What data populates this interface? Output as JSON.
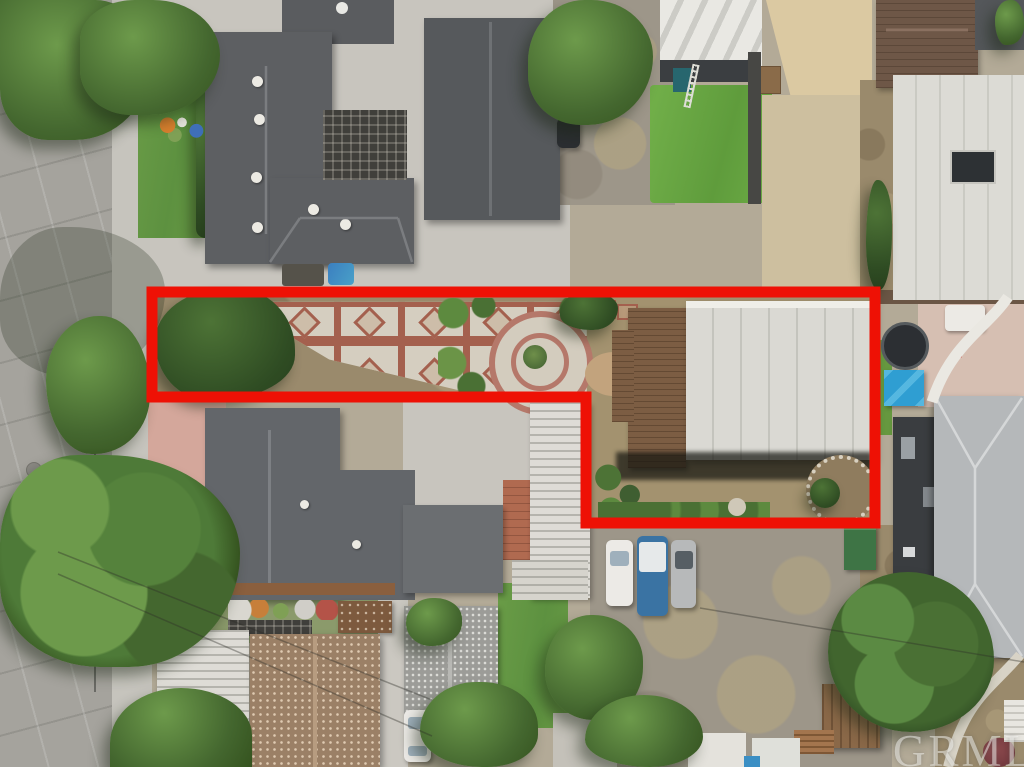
{
  "title": "Aerial drone photo of residential neighborhood with red property boundary outline",
  "watermark": {
    "text": "GRMLS"
  },
  "boundary": {
    "points": "152,292 875,292 875,523 586,523 586,397 152,397",
    "color": "#ee1105",
    "stroke_width_px": 11,
    "shape": "L-shaped lot outline: narrow patio strip on left, full-depth parcel with flat-roof house on right"
  },
  "scene_elements": [
    "tree-lined street on left with parked red and blue cars",
    "large dark-gray hip-roof house top left with lattice pergola",
    "gable-roof house top center with driveway and parked vehicles",
    "artificial turf yard and tan shade canopy top center-right",
    "white flat-roof buildings upper right",
    "outlined lot: tiled patio with diamond motifs, circular garden walkway, brown-shingle and white flat-roof house, round stone planter",
    "second hip-roof house below lot with pink driveway, white carport, brown speckled roof house",
    "gravel parking area with three parked cars",
    "large trees and gray hip-roof house bottom right",
    "GRMLS watermark bottom right"
  ],
  "palette": {
    "boundary_red": "#ee1105",
    "roof_dark_gray": "#5d5f62",
    "roof_brown": "#7c5d43",
    "flat_roof_white": "#dad9d3",
    "patio_tile": "#d5cec0",
    "patio_band": "#a4604e",
    "asphalt": "#a5a39d",
    "turf_green": "#6aa844"
  }
}
